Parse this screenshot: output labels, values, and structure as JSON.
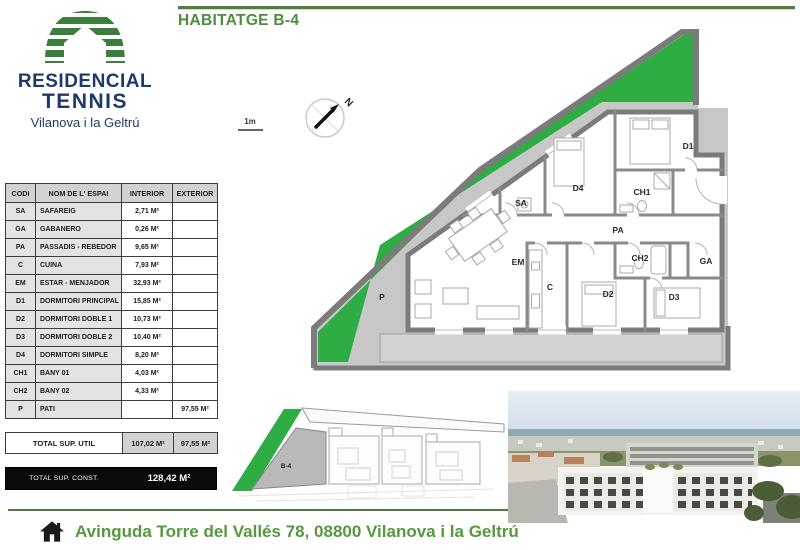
{
  "header": {
    "title": "HABITATGE B-4",
    "logo": {
      "line1": "RESIDENCIAL",
      "line2": "TENNIS",
      "city": "Vilanova i la Geltrú"
    }
  },
  "surface_table": {
    "columns": [
      "CODI",
      "NOM DE L' ESPAI",
      "INTERIOR",
      "EXTERIOR"
    ],
    "rows": [
      {
        "code": "SA",
        "name": "SAFAREIG",
        "interior": "2,71 M²",
        "exterior": ""
      },
      {
        "code": "GA",
        "name": "GABANERO",
        "interior": "0,26 M²",
        "exterior": ""
      },
      {
        "code": "PA",
        "name": "PASSADIS - REBEDOR",
        "interior": "9,65 M²",
        "exterior": ""
      },
      {
        "code": "C",
        "name": "CUINA",
        "interior": "7,93 M²",
        "exterior": ""
      },
      {
        "code": "EM",
        "name": "ESTAR - MENJADOR",
        "interior": "32,93 M²",
        "exterior": ""
      },
      {
        "code": "D1",
        "name": "DORMITORI PRINCIPAL",
        "interior": "15,85 M²",
        "exterior": ""
      },
      {
        "code": "D2",
        "name": "DORMITORI DOBLE 1",
        "interior": "10,73 M²",
        "exterior": ""
      },
      {
        "code": "D3",
        "name": "DORMITORI DOBLE 2",
        "interior": "10,40 M²",
        "exterior": ""
      },
      {
        "code": "D4",
        "name": "DORMITORI SIMPLE",
        "interior": "8,20 M²",
        "exterior": ""
      },
      {
        "code": "CH1",
        "name": "BANY 01",
        "interior": "4,03 M²",
        "exterior": ""
      },
      {
        "code": "CH2",
        "name": "BANY 02",
        "interior": "4,33 M²",
        "exterior": ""
      },
      {
        "code": "P",
        "name": "PATI",
        "interior": "",
        "exterior": "97,55 M²"
      }
    ],
    "total_util": {
      "label": "TOTAL SUP. UTIL",
      "interior": "107,02 M²",
      "exterior": "97,55 M²"
    },
    "total_const": {
      "label": "TOTAL SUP. CONST.",
      "value": "128,42 M²"
    }
  },
  "floor_plan": {
    "scale_label": "1m",
    "north_label": "N",
    "labels": {
      "p": "P",
      "em": "EM",
      "c": "C",
      "sa": "SA",
      "d4": "D4",
      "d1": "D1",
      "ch1": "CH1",
      "pa": "PA",
      "ch2": "CH2",
      "ga": "GA",
      "d2": "D2",
      "d3": "D3"
    }
  },
  "site_plan": {
    "unit_label": "B-4"
  },
  "footer": {
    "address": "Avinguda Torre del Vallés 78, 08800 Vilanova i la Geltrú"
  },
  "colors": {
    "terrace_green": "#2ead45",
    "logo_green": "#3a7d3c",
    "navy": "#1e3a6a",
    "title_green": "#4e8c3e",
    "footer_green": "#55993f",
    "wall_gray": "#7b7b7b",
    "patio_gray": "#c7c7c7"
  }
}
